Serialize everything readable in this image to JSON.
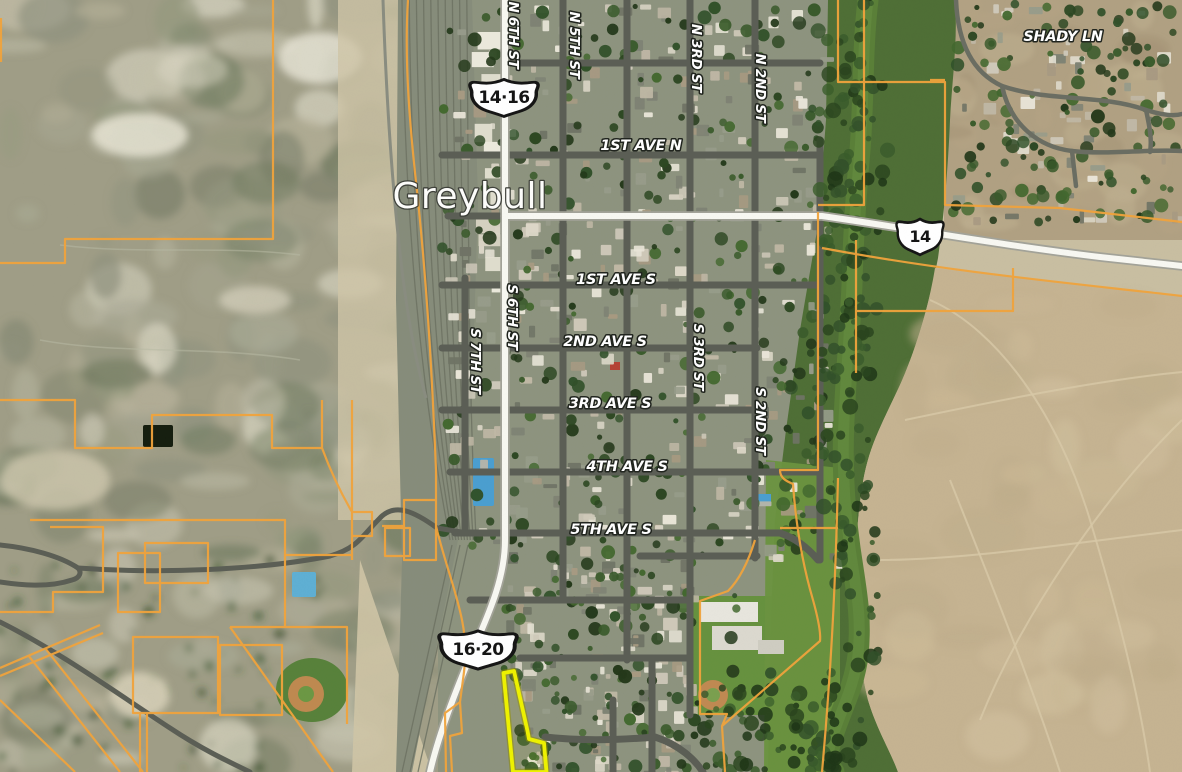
{
  "city_label": "Greybull",
  "region_labels": {
    "shady_ln": "SHADY LN"
  },
  "route_shields": {
    "north": "14·16",
    "east": "14",
    "south": "16·20"
  },
  "street_labels": {
    "n_6th_st": "N 6TH ST",
    "n_5th_st": "N 5TH ST",
    "n_3rd_st": "N 3RD ST",
    "n_2nd_st": "N 2ND ST",
    "first_ave_n": "1ST AVE N",
    "first_ave_s": "1ST AVE S",
    "second_ave_s": "2ND AVE S",
    "third_ave_s": "3RD AVE S",
    "fourth_ave_s": "4TH AVE S",
    "fifth_ave_s": "5TH AVE S",
    "s_7th_st": "S 7TH ST",
    "s_6th_st": "S 6TH ST",
    "s_3rd_st": "S 3RD ST",
    "s_2nd_st": "S 2ND ST"
  },
  "colors": {
    "parcel_line": "#f0a33c",
    "highlight_parcel": "#eef200",
    "road_dark": "#5b5e55",
    "highway_fill": "#f8f8f2",
    "highway_casing": "#a3a399",
    "shield_fill": "#ffffff",
    "shield_outline": "#151515",
    "label_fill": "#ffffff",
    "label_halo": "#20241e",
    "water_river": "#5a7f38",
    "riparian_green": "#4f6f36",
    "field_green": "#6b9440",
    "badlands_gray_green": "#a09e87",
    "desert_tan_west": "#c9bfa2",
    "desert_tan_east": "#c6b492",
    "town_base": "#8e947f",
    "neighborhood_base": "#b1a183",
    "railyard": "#878d7b",
    "pool_blue": "#5fb0d4"
  }
}
